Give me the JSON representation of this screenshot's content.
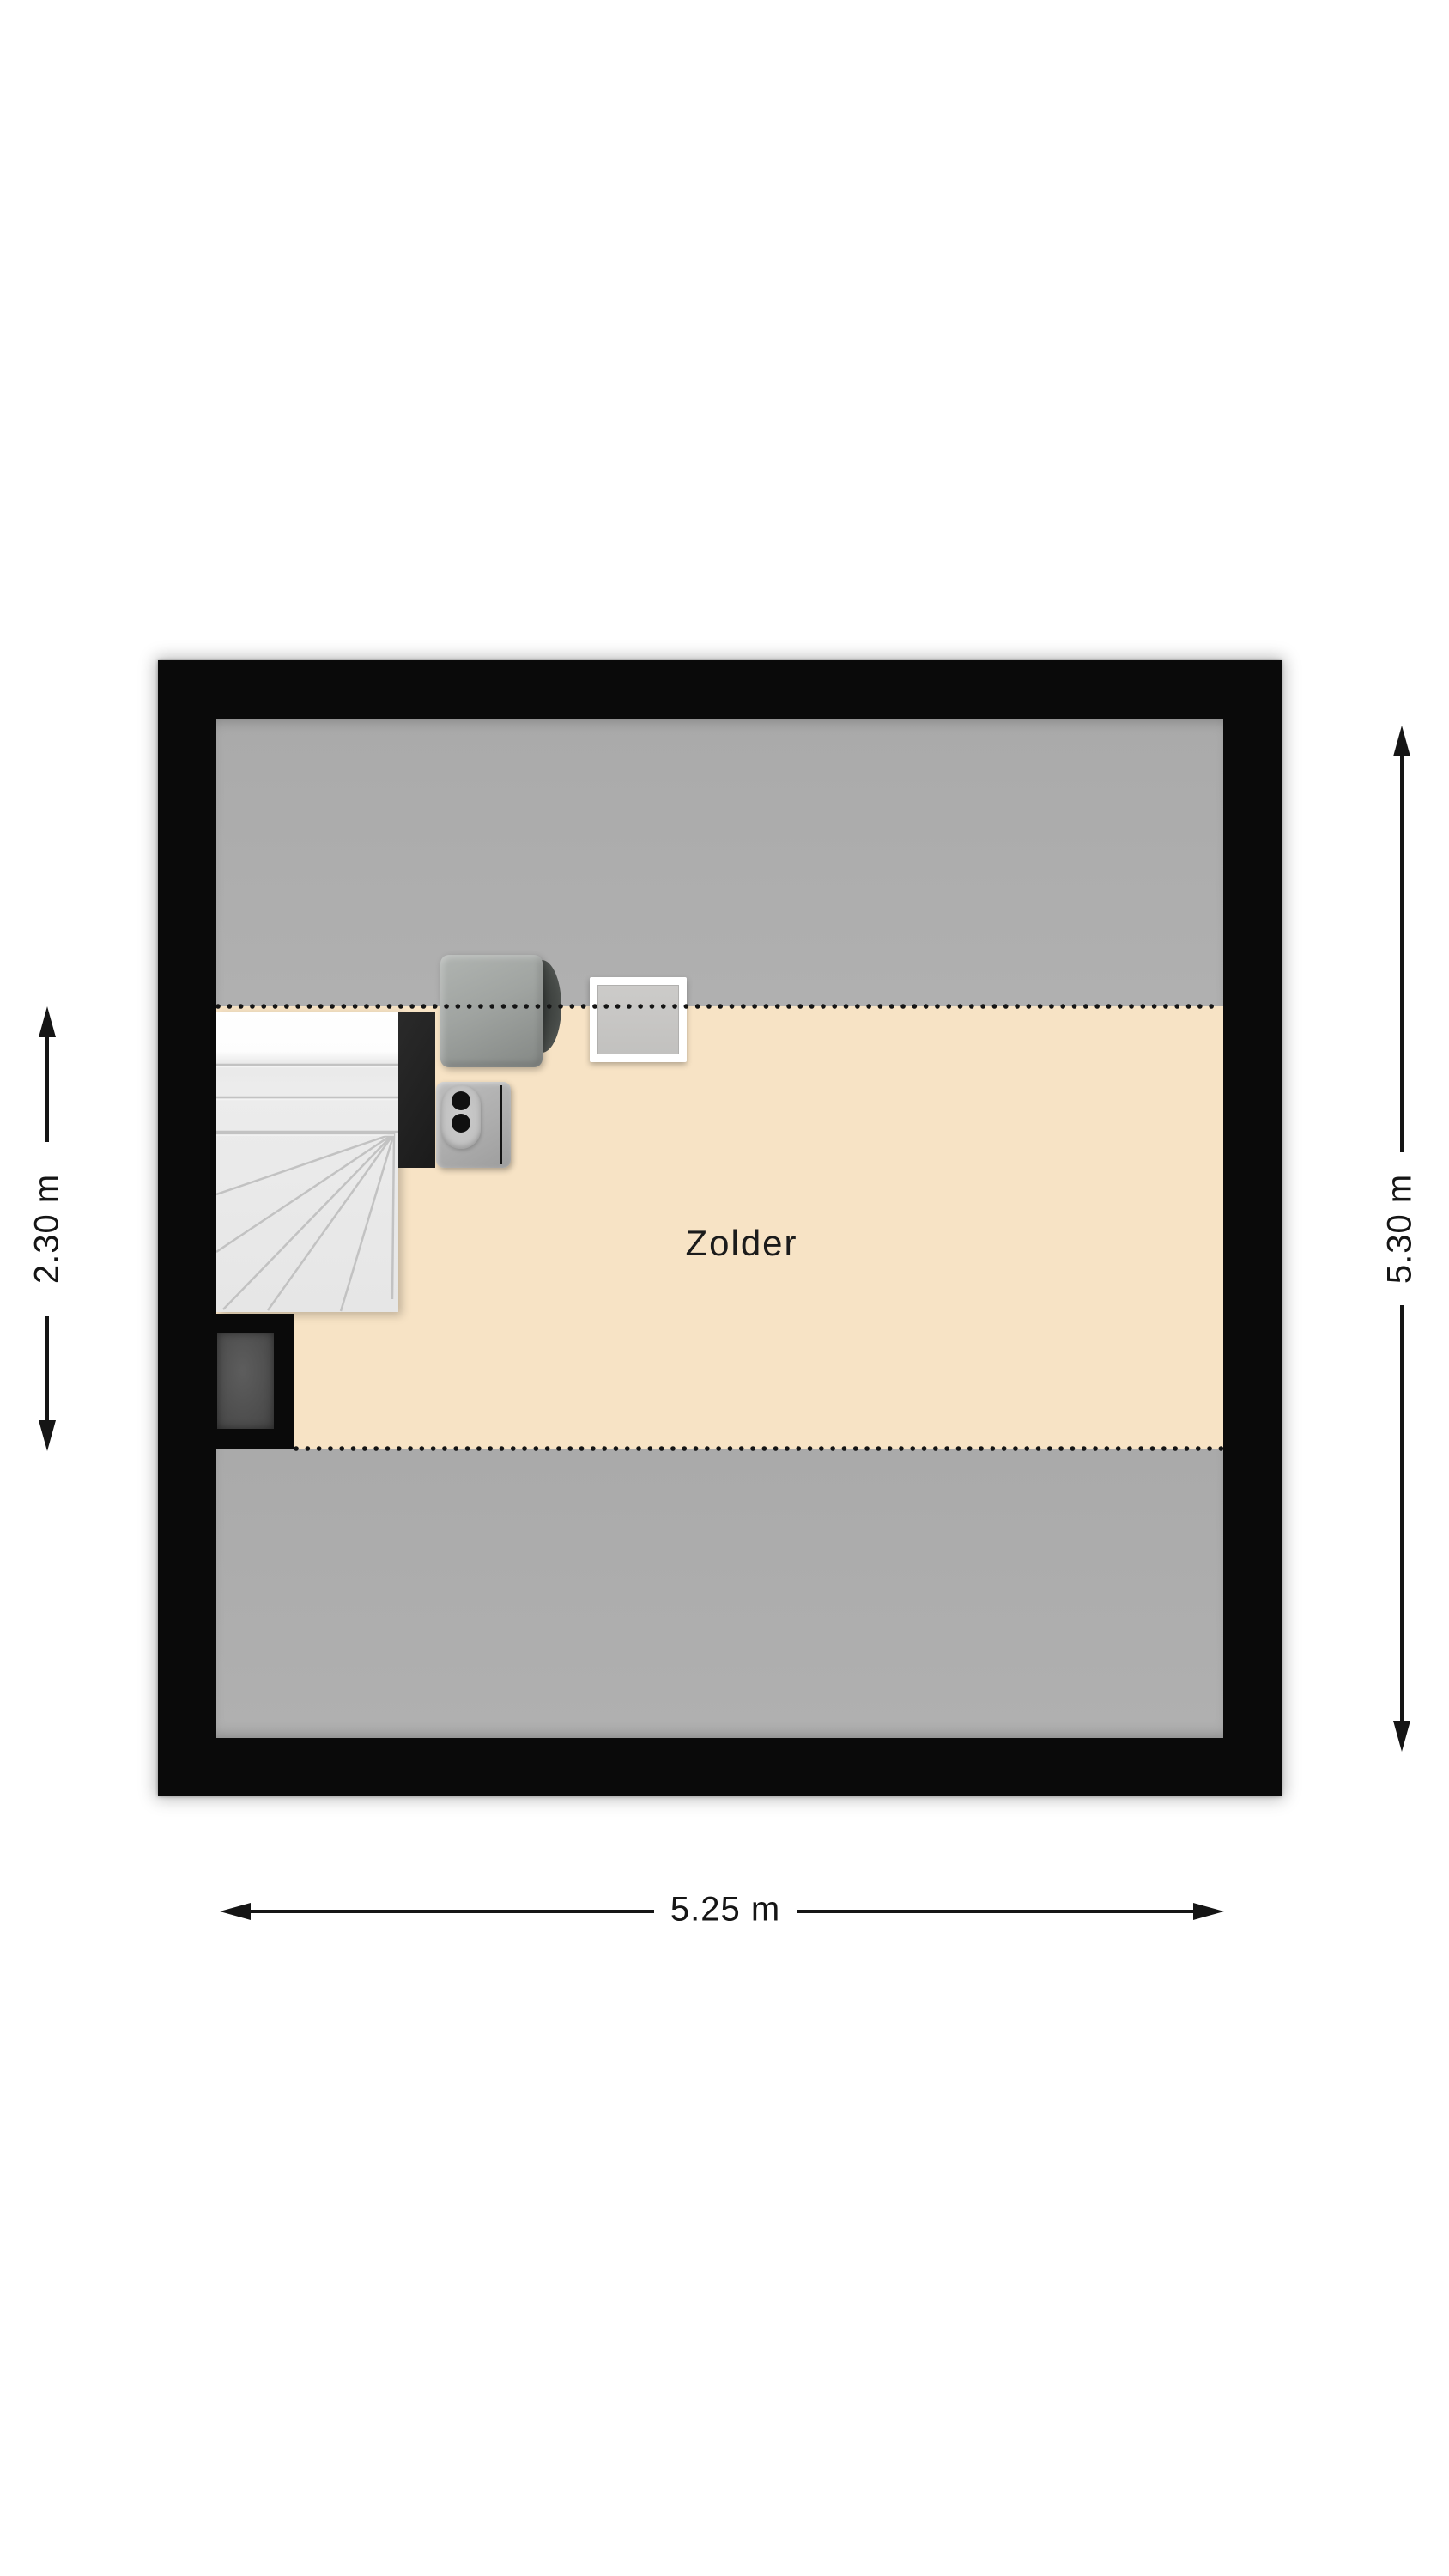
{
  "room": {
    "label": "Zolder"
  },
  "dimensions": {
    "left_height": "2.30 m",
    "right_height": "5.30 m",
    "bottom_width": "5.25 m"
  },
  "furniture": {
    "stairs": "winder-staircase",
    "stair_wall": "stair-wall",
    "cabinet": "storage-cabinet",
    "boiler": "boiler-unit",
    "roof_window": "roof-window",
    "chimney": "chimney-shaft"
  },
  "colors": {
    "wall": "#0a0a0a",
    "floor": "#f7e3c5",
    "low_headroom_zone": "#acacac",
    "dimension_lines": "#151515",
    "background": "#ffffff"
  }
}
